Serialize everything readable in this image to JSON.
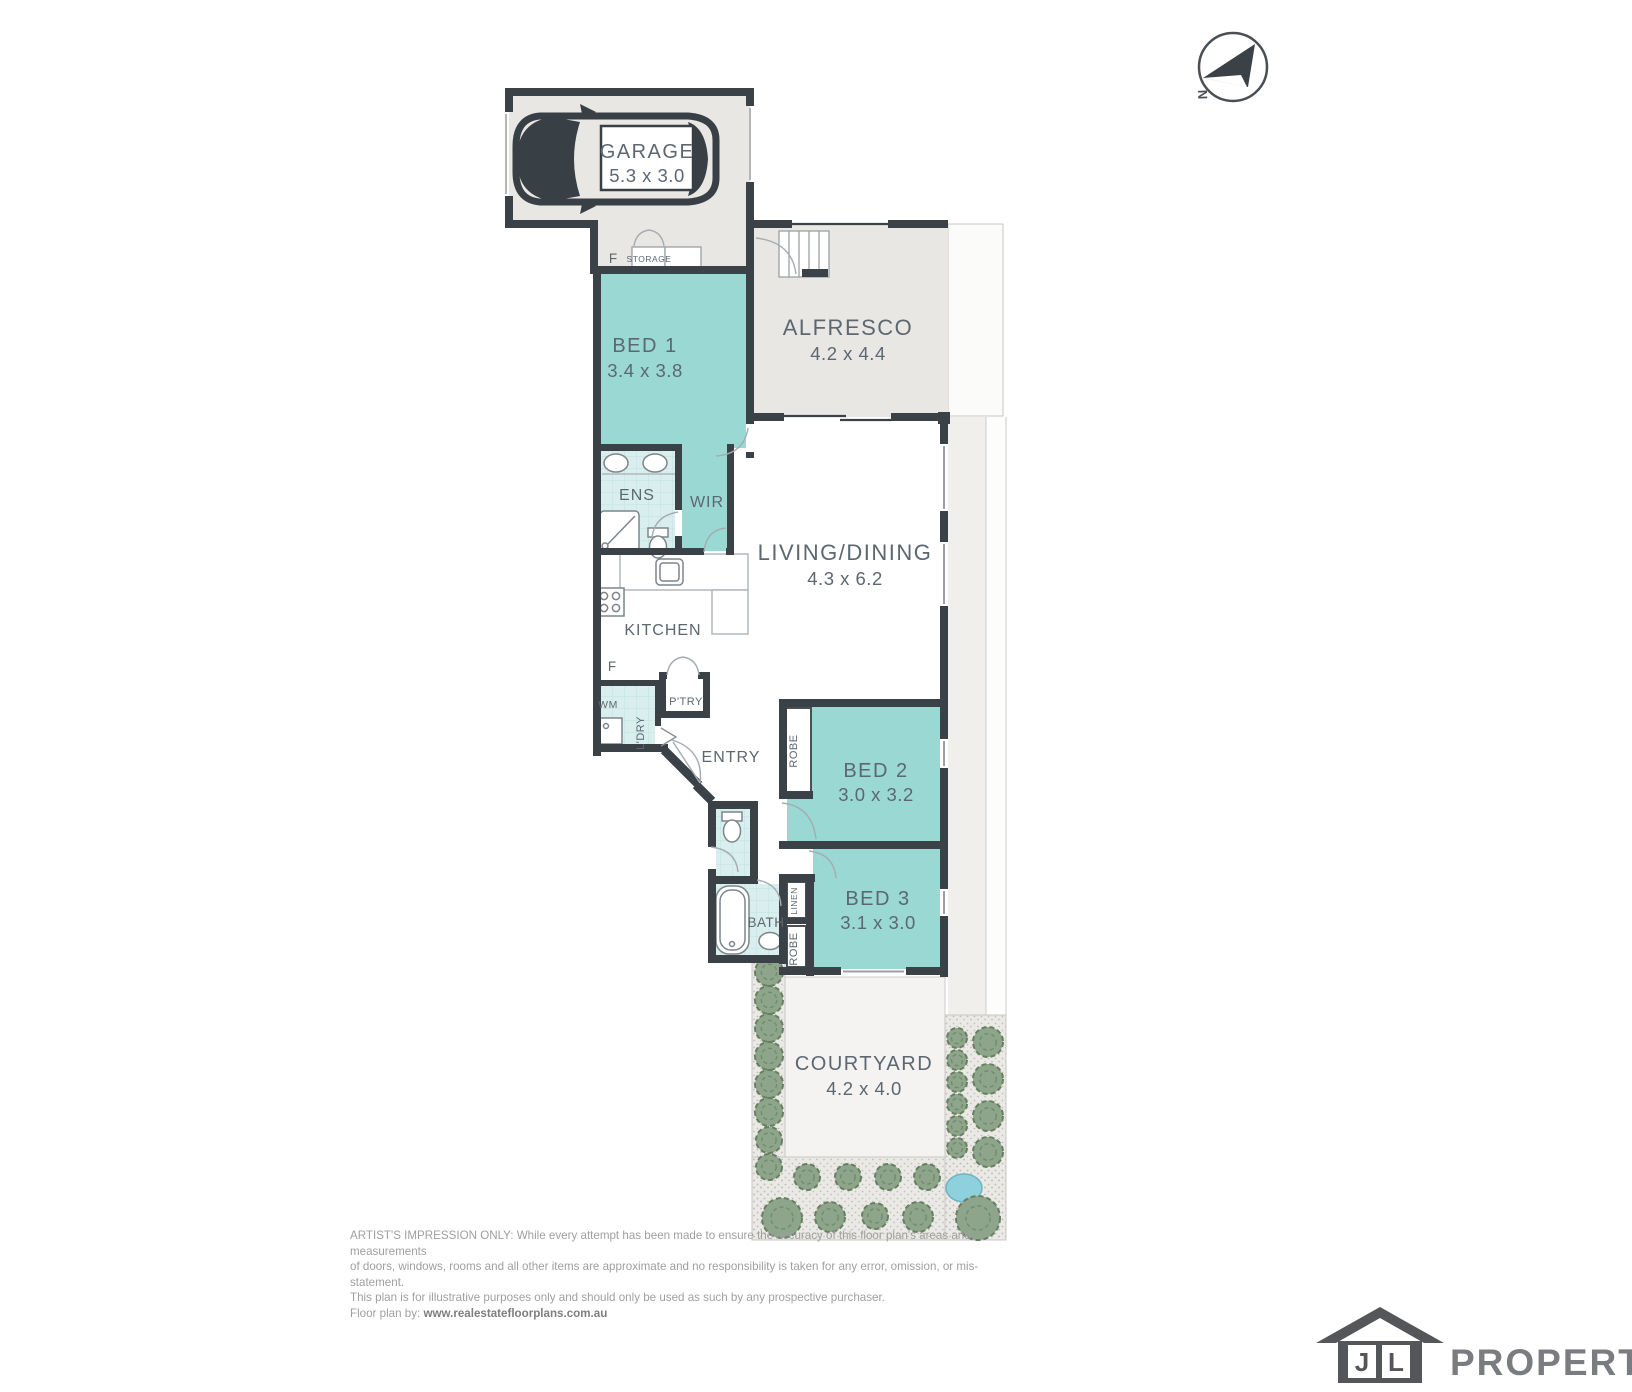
{
  "plan": {
    "rooms": {
      "garage": {
        "name": "GARAGE",
        "dims": "5.3 x 3.0"
      },
      "bed1": {
        "name": "BED 1",
        "dims": "3.4 x 3.8"
      },
      "alfresco": {
        "name": "ALFRESCO",
        "dims": "4.2 x 4.4"
      },
      "living": {
        "name": "LIVING/DINING",
        "dims": "4.3 x 6.2"
      },
      "bed2": {
        "name": "BED 2",
        "dims": "3.0 x 3.2"
      },
      "bed3": {
        "name": "BED 3",
        "dims": "3.1 x 3.0"
      },
      "courtyard": {
        "name": "COURTYARD",
        "dims": "4.2 x 4.0"
      }
    },
    "labels": {
      "ens": "ENS",
      "wir": "WIR",
      "kitchen": "KITCHEN",
      "entry": "ENTRY",
      "bath": "BATH",
      "pantry": "P'TRY",
      "laundry": "L'DRY",
      "wm": "WM",
      "robe_bed2": "ROBE",
      "robe_bed3": "ROBE",
      "linen": "LINEN",
      "storage": "STORAGE",
      "fridge_storage": "F",
      "fridge_kitchen": "F"
    }
  },
  "compass": {
    "north_label": "N"
  },
  "garden": {
    "trees": [
      [
        769,
        972,
        14
      ],
      [
        769,
        1000,
        14
      ],
      [
        769,
        1028,
        14
      ],
      [
        769,
        1056,
        14
      ],
      [
        769,
        1084,
        14
      ],
      [
        769,
        1112,
        14
      ],
      [
        769,
        1140,
        13
      ],
      [
        769,
        1167,
        13
      ],
      [
        807,
        1177,
        13
      ],
      [
        848,
        1177,
        13
      ],
      [
        888,
        1177,
        13
      ],
      [
        927,
        1177,
        13
      ],
      [
        782,
        1218,
        20
      ],
      [
        830,
        1217,
        15
      ],
      [
        875,
        1216,
        13
      ],
      [
        918,
        1217,
        15
      ],
      [
        978,
        1218,
        22
      ],
      [
        957,
        1038,
        10
      ],
      [
        957,
        1060,
        10
      ],
      [
        957,
        1082,
        10
      ],
      [
        957,
        1104,
        10
      ],
      [
        957,
        1126,
        10
      ],
      [
        957,
        1148,
        10
      ],
      [
        988,
        1042,
        15
      ],
      [
        988,
        1079,
        15
      ],
      [
        988,
        1116,
        15
      ],
      [
        988,
        1152,
        15
      ]
    ],
    "pond": {
      "cx": 964,
      "cy": 1188,
      "rx": 18,
      "ry": 14
    }
  },
  "disclaimer": {
    "line1": "ARTIST'S IMPRESSION ONLY: While every attempt has been made to ensure the accuracy of this floor plan's areas and measurements",
    "line2": "of doors, windows, rooms and all other items are approximate and no responsibility is taken for any error, omission, or mis-statement.",
    "line3": "This plan is for illustrative purposes only and should only be used as such by any prospective purchaser.",
    "credit_prefix": "Floor plan by: ",
    "credit_url": "www.realestatefloorplans.com.au"
  },
  "branding": {
    "initial_j": "J",
    "initial_l": "L",
    "wordmark": "PROPERTY"
  },
  "colors": {
    "wall": "#3a4147",
    "room_teal": "#9ad8d4",
    "tile_teal": "#d9efee",
    "area_grey": "#e9e7e4",
    "tree_green": "#8ea58c",
    "pond_blue": "#8fd0dd",
    "label_text": "#5d6771",
    "logo_dark": "#55565a",
    "logo_grey": "#7b7c80"
  }
}
